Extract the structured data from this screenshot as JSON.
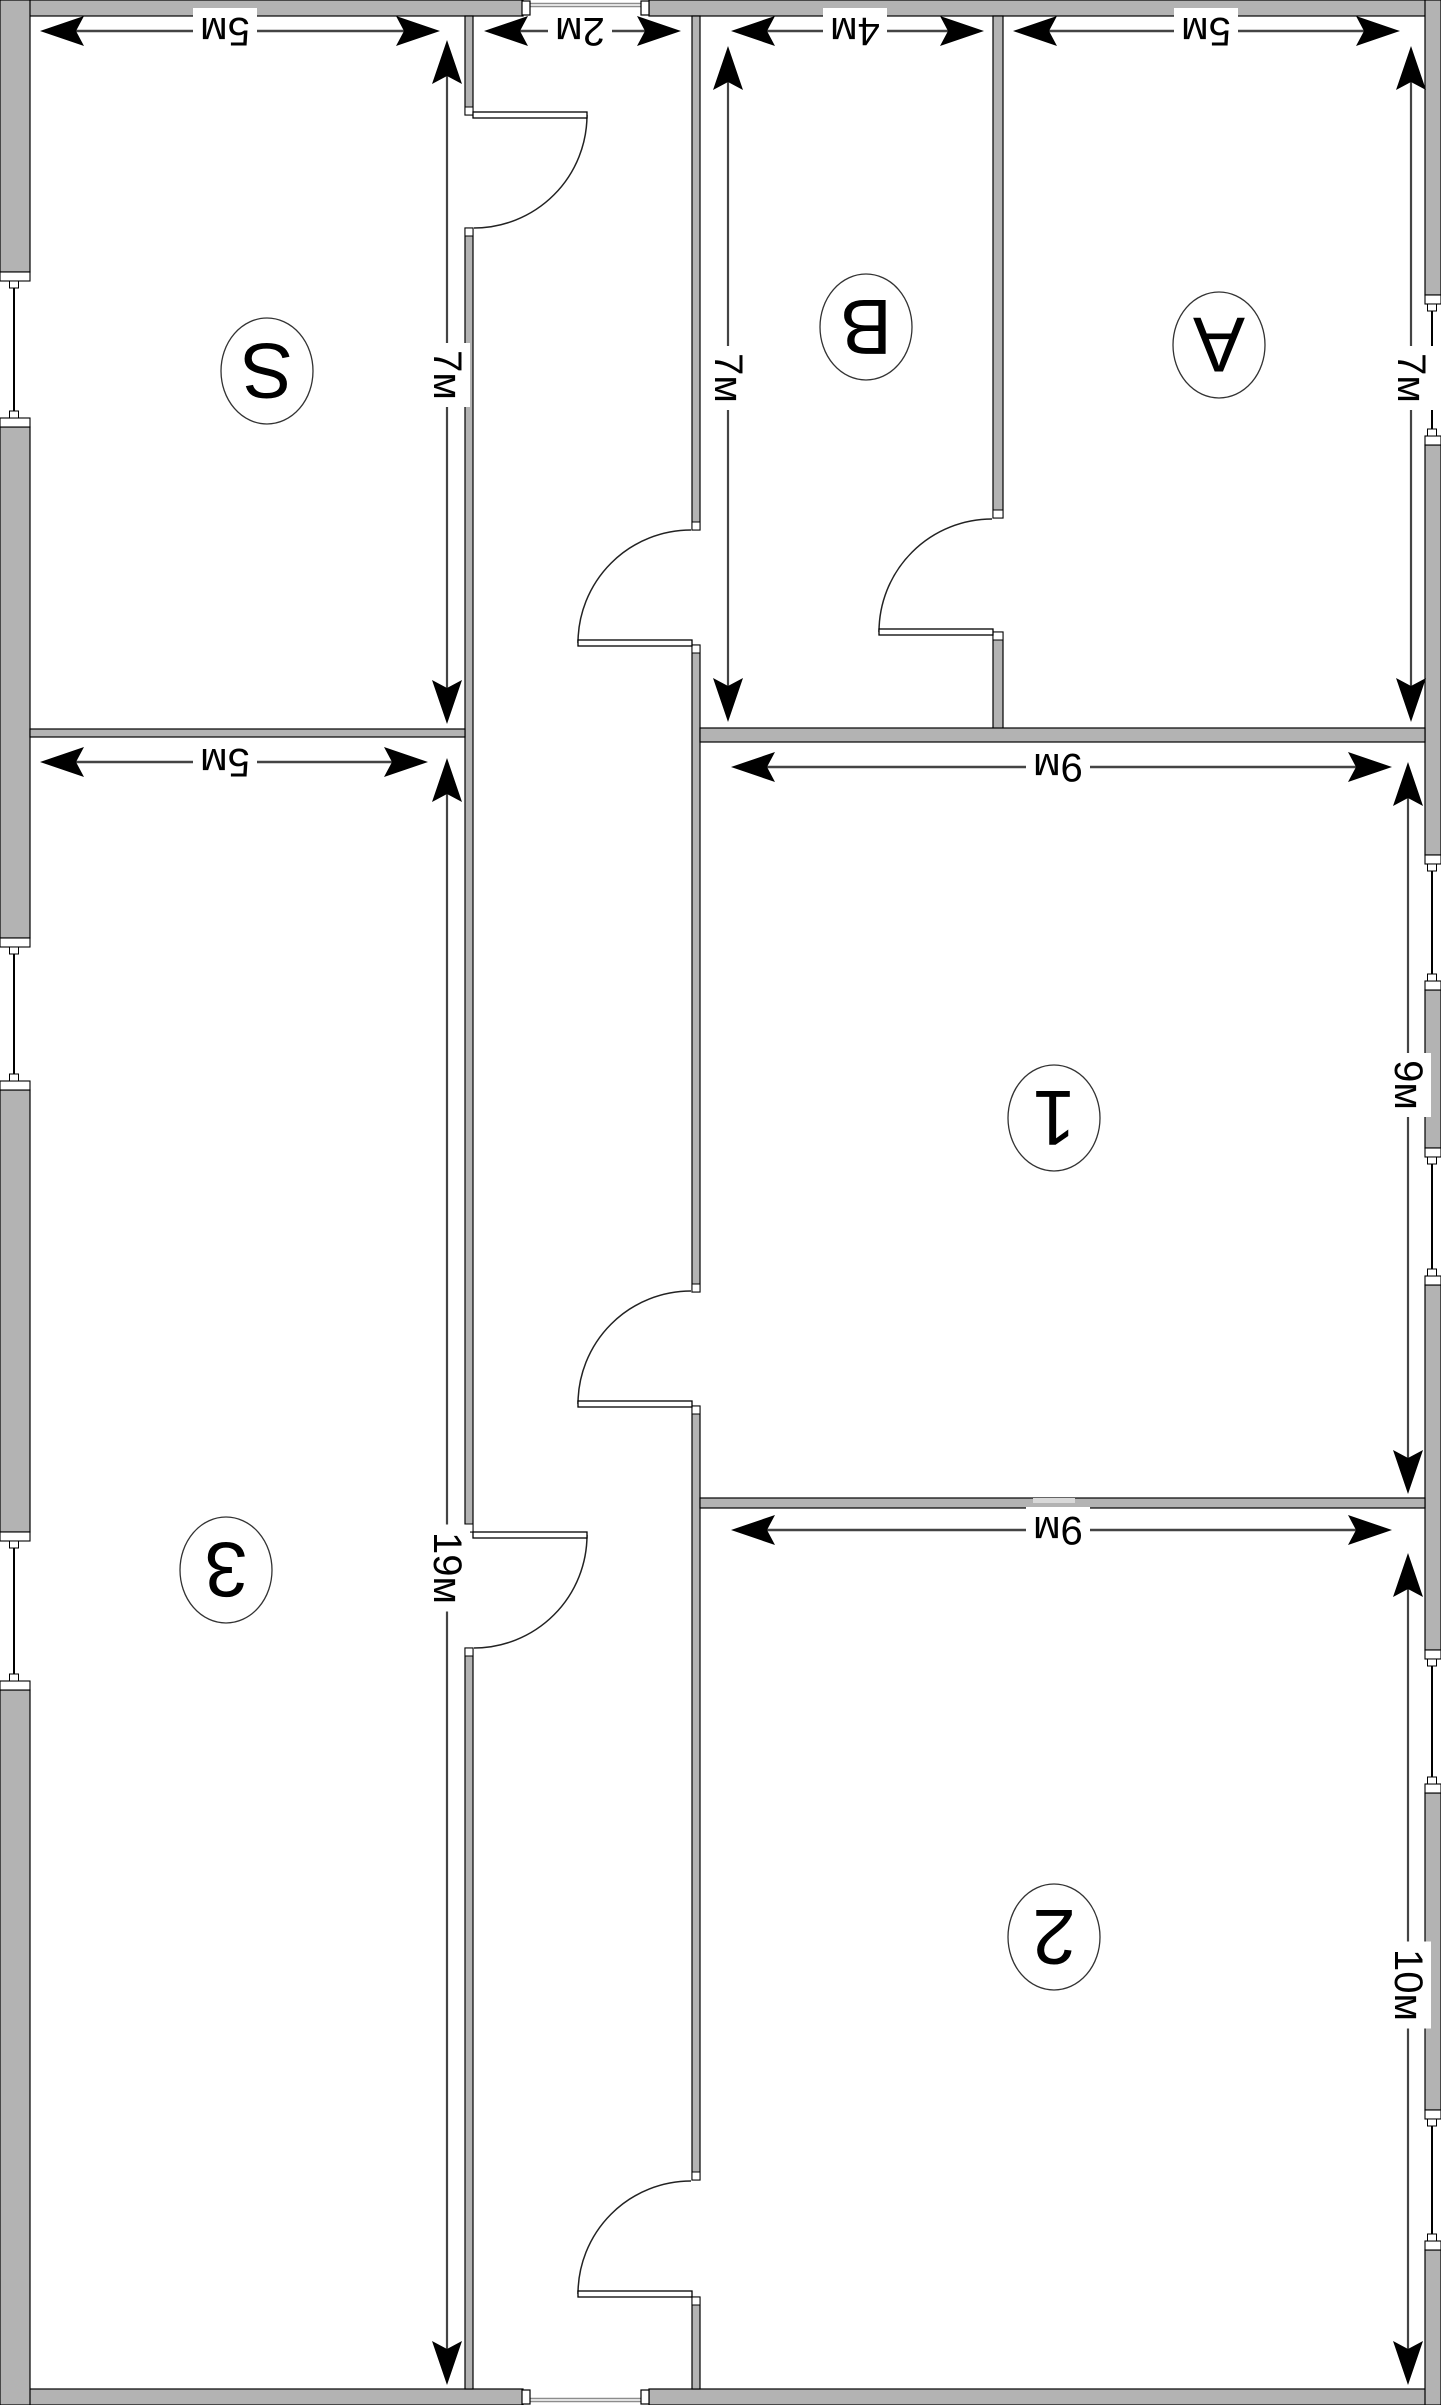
{
  "title": "Floor plan (rotated 180°)",
  "units": "м",
  "canvas": {
    "width": 1441,
    "height": 2405
  },
  "colors": {
    "background": "#ffffff",
    "wall_fill": "#b3b3b3",
    "wall_outline": "#000000",
    "light_patch": "#d9d9d9",
    "dim_line": "#444444",
    "arrow": "#000000",
    "text": "#000000",
    "arc": "#222222",
    "threshold": "#8c8c8c"
  },
  "rooms": [
    {
      "id": "room-s",
      "label": "S",
      "width_m": 5,
      "height_m": 7,
      "cx": 267,
      "cy": 371
    },
    {
      "id": "room-b",
      "label": "B",
      "width_m": 4,
      "height_m": 7,
      "cx": 866,
      "cy": 327
    },
    {
      "id": "room-a",
      "label": "A",
      "width_m": 5,
      "height_m": 7,
      "cx": 1219,
      "cy": 345
    },
    {
      "id": "room-1",
      "label": "1",
      "width_m": 9,
      "height_m": 9,
      "cx": 1054,
      "cy": 1118
    },
    {
      "id": "room-2",
      "label": "2",
      "width_m": 9,
      "height_m": 10,
      "cx": 1054,
      "cy": 1937
    },
    {
      "id": "room-3",
      "label": "3",
      "width_m": 5,
      "height_m": 19,
      "cx": 226,
      "cy": 1570
    }
  ],
  "dims": {
    "horizontal": [
      {
        "id": "dim-s-width",
        "text": "5м",
        "y": 31,
        "x1": 40,
        "x2": 440,
        "lx": 225
      },
      {
        "id": "dim-entry",
        "text": "2м",
        "y": 31,
        "x1": 484,
        "x2": 681,
        "lx": 580
      },
      {
        "id": "dim-b-width",
        "text": "4м",
        "y": 31,
        "x1": 731,
        "x2": 984,
        "lx": 855
      },
      {
        "id": "dim-a-width",
        "text": "5м",
        "y": 31,
        "x1": 1013,
        "x2": 1400,
        "lx": 1206
      },
      {
        "id": "dim-1-width",
        "text": "9м",
        "y": 767,
        "x1": 731,
        "x2": 1392,
        "lx": 1058
      },
      {
        "id": "dim-2-width",
        "text": "9м",
        "y": 1530,
        "x1": 731,
        "x2": 1392,
        "lx": 1058
      },
      {
        "id": "dim-3-width",
        "text": "5м",
        "y": 762,
        "x1": 40,
        "x2": 428,
        "lx": 225
      }
    ],
    "vertical": [
      {
        "id": "dim-s-height",
        "text": "7м",
        "x": 447,
        "y1": 40,
        "y2": 724,
        "ly": 375
      },
      {
        "id": "dim-b-height",
        "text": "7м",
        "x": 728,
        "y1": 46,
        "y2": 722,
        "ly": 378
      },
      {
        "id": "dim-a-height",
        "text": "7м",
        "x": 1411,
        "y1": 46,
        "y2": 722,
        "ly": 378
      },
      {
        "id": "dim-1-height",
        "text": "9м",
        "x": 1408,
        "y1": 762,
        "y2": 1494,
        "ly": 1085
      },
      {
        "id": "dim-2-height",
        "text": "10м",
        "x": 1408,
        "y1": 1553,
        "y2": 2385,
        "ly": 1985
      },
      {
        "id": "dim-3-height",
        "text": "19м",
        "x": 447,
        "y1": 758,
        "y2": 2385,
        "ly": 1568
      }
    ]
  },
  "walls": [
    {
      "id": "wall-ext-top-left",
      "x": 0,
      "y": 0,
      "w": 523,
      "h": 16
    },
    {
      "id": "wall-ext-top-right",
      "x": 649,
      "y": 0,
      "w": 792,
      "h": 16
    },
    {
      "id": "wall-ext-bottom-left",
      "x": 0,
      "y": 2389,
      "w": 523,
      "h": 16
    },
    {
      "id": "wall-ext-bottom-right",
      "x": 649,
      "y": 2389,
      "w": 792,
      "h": 16
    },
    {
      "id": "wall-ext-left-1",
      "x": 0,
      "y": 0,
      "w": 30,
      "h": 272
    },
    {
      "id": "wall-ext-left-2",
      "x": 0,
      "y": 427,
      "w": 30,
      "h": 511
    },
    {
      "id": "wall-ext-left-3",
      "x": 0,
      "y": 1090,
      "w": 30,
      "h": 442
    },
    {
      "id": "wall-ext-left-4",
      "x": 0,
      "y": 1690,
      "w": 30,
      "h": 715
    },
    {
      "id": "wall-ext-right-1",
      "x": 1425,
      "y": 0,
      "w": 16,
      "h": 295
    },
    {
      "id": "wall-ext-right-2",
      "x": 1425,
      "y": 445,
      "w": 16,
      "h": 410
    },
    {
      "id": "wall-ext-right-3",
      "x": 1425,
      "y": 990,
      "w": 16,
      "h": 158
    },
    {
      "id": "wall-ext-right-4",
      "x": 1425,
      "y": 1285,
      "w": 16,
      "h": 365
    },
    {
      "id": "wall-ext-right-5",
      "x": 1425,
      "y": 1793,
      "w": 16,
      "h": 317
    },
    {
      "id": "wall-ext-right-6",
      "x": 1425,
      "y": 2250,
      "w": 16,
      "h": 155
    },
    {
      "id": "wall-corridor-left-1",
      "x": 465,
      "y": 16,
      "w": 8,
      "h": 99
    },
    {
      "id": "wall-corridor-left-2",
      "x": 465,
      "y": 228,
      "w": 8,
      "h": 1304
    },
    {
      "id": "wall-corridor-left-3",
      "x": 465,
      "y": 1648,
      "w": 8,
      "h": 741
    },
    {
      "id": "wall-corridor-right-1",
      "x": 692,
      "y": 16,
      "w": 8,
      "h": 514
    },
    {
      "id": "wall-corridor-right-2",
      "x": 692,
      "y": 645,
      "w": 8,
      "h": 647
    },
    {
      "id": "wall-corridor-right-3",
      "x": 692,
      "y": 1406,
      "w": 8,
      "h": 774
    },
    {
      "id": "wall-corridor-right-4",
      "x": 692,
      "y": 2297,
      "w": 8,
      "h": 92
    },
    {
      "id": "wall-b-a-1",
      "x": 993,
      "y": 16,
      "w": 10,
      "h": 502
    },
    {
      "id": "wall-b-a-2",
      "x": 993,
      "y": 632,
      "w": 10,
      "h": 105
    },
    {
      "id": "wall-s-3",
      "x": 30,
      "y": 729,
      "w": 435,
      "h": 8
    },
    {
      "id": "wall-ba-1",
      "x": 700,
      "y": 728,
      "w": 725,
      "h": 14
    },
    {
      "id": "wall-1-2",
      "x": 700,
      "y": 1498,
      "w": 725,
      "h": 10
    }
  ],
  "light_patch": {
    "id": "wall-1-2-patch",
    "x": 1033,
    "y": 1498,
    "w": 42,
    "h": 5
  },
  "caps": [
    {
      "x": 465,
      "y": 107,
      "w": 8,
      "h": 8
    },
    {
      "x": 465,
      "y": 228,
      "w": 8,
      "h": 8
    },
    {
      "x": 465,
      "y": 1524,
      "w": 8,
      "h": 8
    },
    {
      "x": 465,
      "y": 1648,
      "w": 8,
      "h": 8
    },
    {
      "x": 692,
      "y": 522,
      "w": 8,
      "h": 8
    },
    {
      "x": 692,
      "y": 645,
      "w": 8,
      "h": 8
    },
    {
      "x": 692,
      "y": 1284,
      "w": 8,
      "h": 8
    },
    {
      "x": 692,
      "y": 1406,
      "w": 8,
      "h": 8
    },
    {
      "x": 692,
      "y": 2172,
      "w": 8,
      "h": 8
    },
    {
      "x": 692,
      "y": 2297,
      "w": 8,
      "h": 8
    },
    {
      "x": 993,
      "y": 510,
      "w": 10,
      "h": 8
    },
    {
      "x": 993,
      "y": 632,
      "w": 10,
      "h": 8
    }
  ],
  "doors": [
    {
      "id": "door-room-s",
      "leaf": {
        "x": 473,
        "y": 112,
        "w": 114,
        "h": 6
      },
      "arc": "M 587 115 A 113 113 0 0 1 474 228"
    },
    {
      "id": "door-room-3",
      "leaf": {
        "x": 473,
        "y": 1532,
        "w": 114,
        "h": 6
      },
      "arc": "M 587 1535 A 113 113 0 0 1 474 1648"
    },
    {
      "id": "door-room-b",
      "leaf": {
        "x": 578,
        "y": 640,
        "w": 114,
        "h": 6
      },
      "arc": "M 578 643 A 113 113 0 0 1 691 530"
    },
    {
      "id": "door-room-1",
      "leaf": {
        "x": 578,
        "y": 1401,
        "w": 114,
        "h": 6
      },
      "arc": "M 578 1404 A 113 113 0 0 1 691 1291"
    },
    {
      "id": "door-room-2",
      "leaf": {
        "x": 578,
        "y": 2291,
        "w": 114,
        "h": 6
      },
      "arc": "M 578 2294 A 113 113 0 0 1 691 2181"
    },
    {
      "id": "door-b-to-a",
      "leaf": {
        "x": 879,
        "y": 629,
        "w": 114,
        "h": 6
      },
      "arc": "M 879 632 A 113 113 0 0 1 992 519"
    }
  ],
  "windows": [
    {
      "id": "window-s-left",
      "side": "left",
      "y1": 272,
      "y2": 427
    },
    {
      "id": "window-3-left-1",
      "side": "left",
      "y1": 938,
      "y2": 1090
    },
    {
      "id": "window-3-left-2",
      "side": "left",
      "y1": 1532,
      "y2": 1690
    },
    {
      "id": "window-a-right",
      "side": "right",
      "y1": 295,
      "y2": 445
    },
    {
      "id": "window-1-right-1",
      "side": "right",
      "y1": 855,
      "y2": 990
    },
    {
      "id": "window-1-right-2",
      "side": "right",
      "y1": 1148,
      "y2": 1285
    },
    {
      "id": "window-2-right-1",
      "side": "right",
      "y1": 1650,
      "y2": 1793
    },
    {
      "id": "window-2-right-2",
      "side": "right",
      "y1": 2110,
      "y2": 2250
    }
  ],
  "openings": [
    {
      "id": "entry-top",
      "x1": 522,
      "x2": 649,
      "wall_y": 0,
      "tick_y": 1,
      "line_y1": 3.5,
      "line_y2": 6.5
    },
    {
      "id": "entry-bottom",
      "x1": 522,
      "x2": 649,
      "wall_y": 2389,
      "tick_y": 2390,
      "line_y1": 2398.5,
      "line_y2": 2401.5
    }
  ]
}
